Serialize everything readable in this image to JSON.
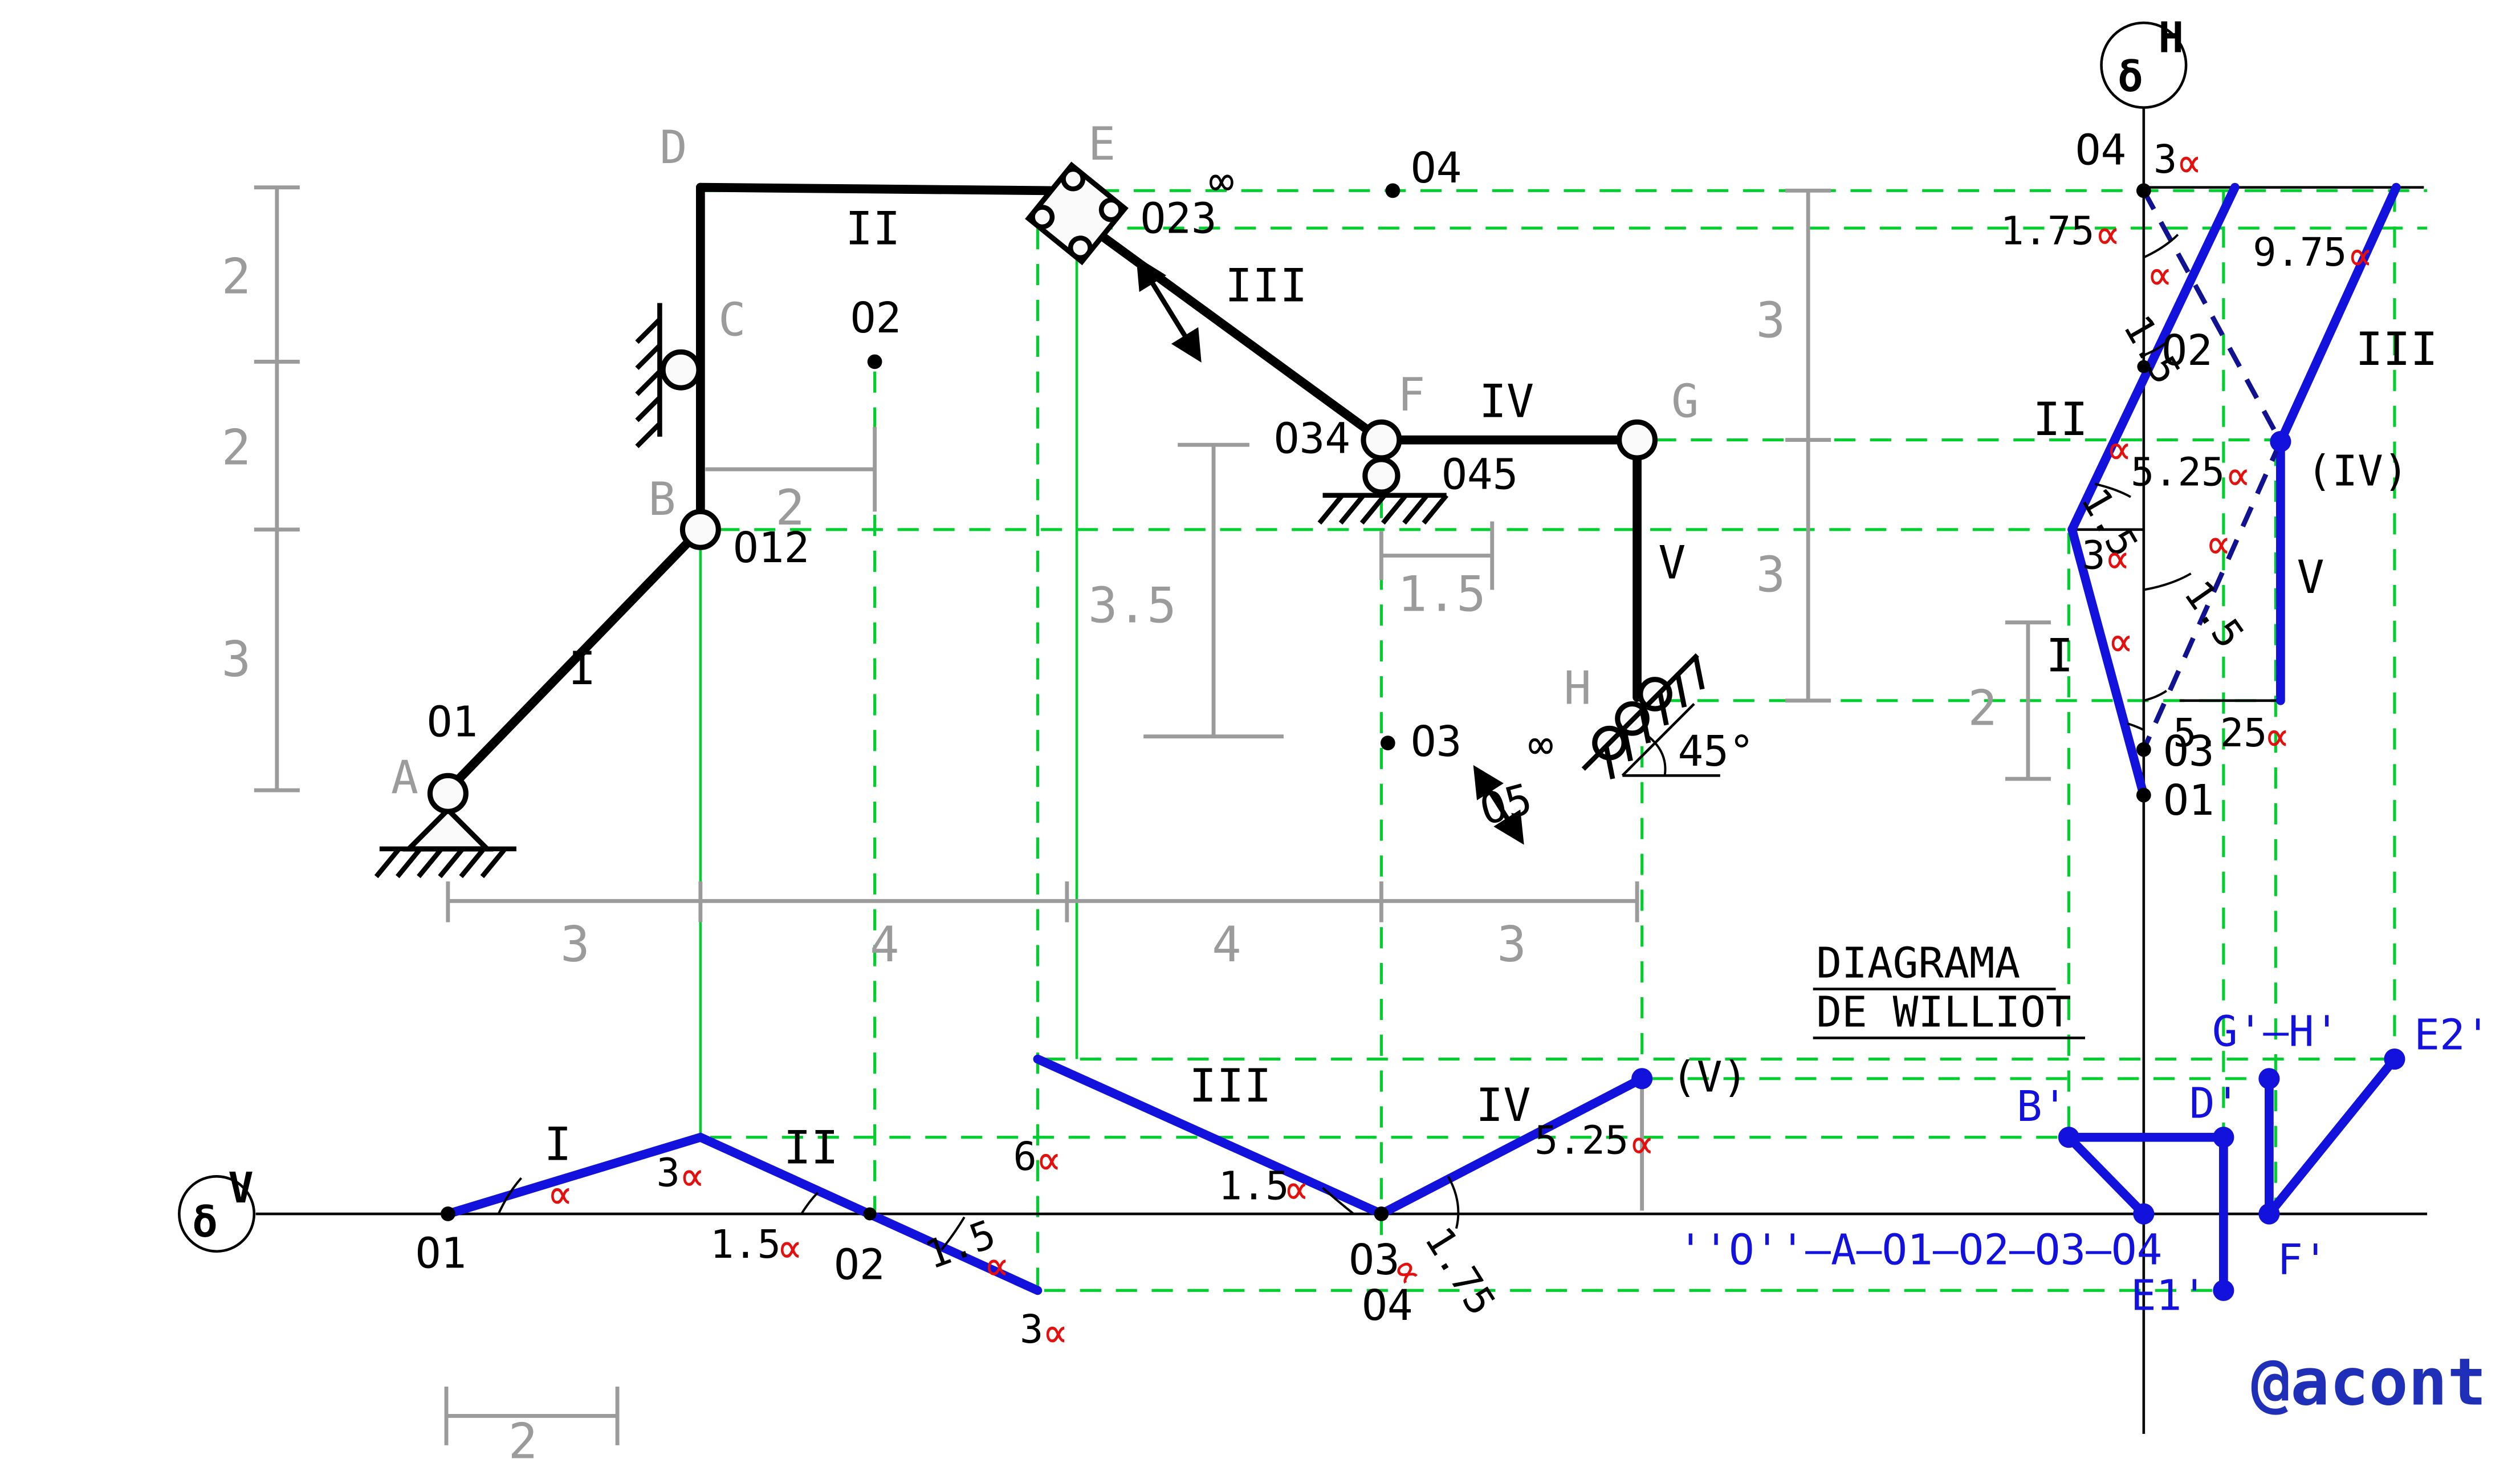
{
  "sym": {
    "alpha": "∝",
    "inf": "∞",
    "delta": "δ",
    "sup_v": "V",
    "sup_h": "H",
    "deg45": "45°"
  },
  "title": {
    "l1": "DIAGRAMA",
    "l2": "DE WILLIOT"
  },
  "watermark": "@acont",
  "structure": {
    "joints": {
      "a": "A",
      "b": "B",
      "c": "C",
      "d": "D",
      "e": "E",
      "f": "F",
      "g": "G",
      "h": "H"
    },
    "links": {
      "i": "I",
      "ii": "II",
      "iii": "III",
      "iv": "IV",
      "v": "V"
    },
    "poles": {
      "o1": "O1",
      "o12": "O12",
      "o2": "O2",
      "o23": "O23",
      "o3": "O3",
      "o34": "O34",
      "o4": "O4",
      "o45": "O45",
      "o5": "O5"
    },
    "dims": {
      "left": [
        "2",
        "2",
        "3"
      ],
      "bottom": [
        "3",
        "4",
        "4",
        "3"
      ],
      "width_b_o2": "2",
      "drop_f": "3.5",
      "right_f": "1.5",
      "right": [
        "3",
        "3"
      ]
    }
  },
  "dv": {
    "o1": "O1",
    "o2": "O2",
    "o3": "O3",
    "o4": "O4",
    "pv": "(V)",
    "i": "I",
    "ii": "II",
    "iii": "III",
    "iv": "IV",
    "n3a": "3",
    "n15a": "1.5",
    "n15b": "1.5",
    "n3b": "3",
    "n6": "6",
    "n15c": "1.5",
    "n175": "1.75",
    "n525": "5.25",
    "dim2": "2"
  },
  "dh": {
    "o4": "O4",
    "o2": "O2",
    "o3": "O3",
    "o1": "O1",
    "piv": "(IV)",
    "i": "I",
    "ii": "II",
    "iii": "III",
    "v": "V",
    "n3top": "3",
    "n975": "9.75",
    "n175": "1.75",
    "n15a": "1.5",
    "n15b": "1.5",
    "n15c": "1.5",
    "n3": "3",
    "n525a": "5.25",
    "n525b": "5.25",
    "dim2": "2"
  },
  "wp": {
    "b": "B'",
    "d": "D'",
    "gh": "G'–H'",
    "e1": "E1'",
    "e2": "E2'",
    "f": "F'",
    "origin": "''O''–A–O1–O2–O3–O4"
  }
}
